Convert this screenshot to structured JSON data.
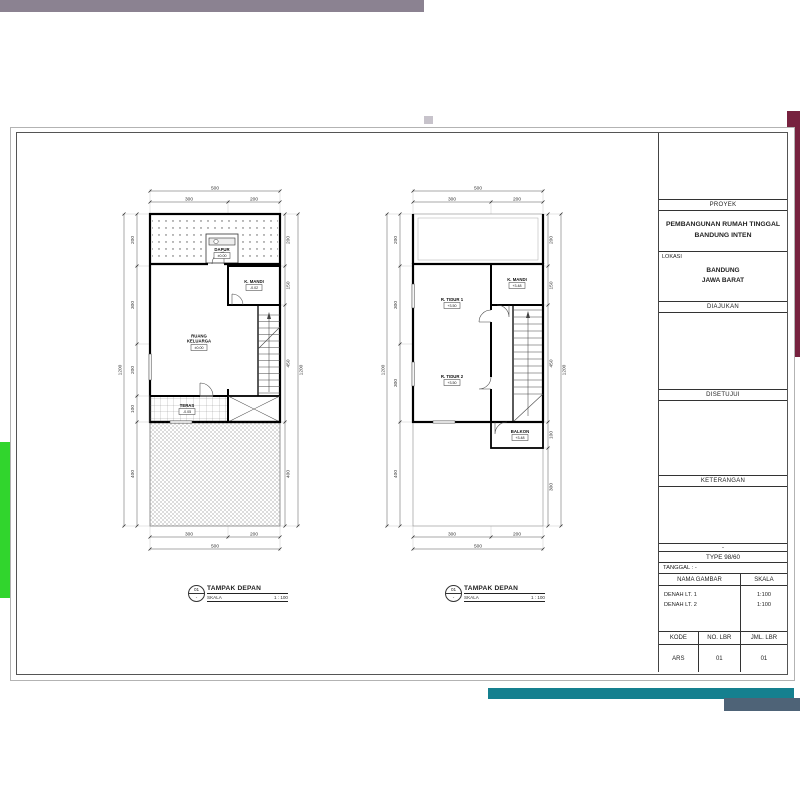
{
  "decor": {
    "gray": "#8b8291",
    "gray_stub": "#c7c3cb",
    "maroon": "#77223f",
    "green": "#31d52d",
    "teal": "#15808f",
    "slate": "#4e6377"
  },
  "title_block": {
    "proyek_label": "PROYEK",
    "proyek_line1": "PEMBANGUNAN RUMAH TINGGAL",
    "proyek_line2": "BANDUNG INTEN",
    "lokasi_label": "LOKASI",
    "lokasi_line1": "BANDUNG",
    "lokasi_line2": "JAWA BARAT",
    "diajukan_label": "DIAJUKAN",
    "disetujui_label": "DISETUJUI",
    "keterangan_label": "KETERANGAN",
    "dash": "-",
    "type_value": "TYPE 98/60",
    "tanggal_label": "TANGGAL : -",
    "nama_gambar_label": "NAMA GAMBAR",
    "skala_label": "SKALA",
    "drawings": [
      {
        "name": "DENAH LT. 1",
        "scale": "1:100"
      },
      {
        "name": "DENAH LT. 2",
        "scale": "1:100"
      }
    ],
    "kode_label": "KODE",
    "no_lbr_label": "NO. LBR",
    "jml_lbr_label": "JML. LBR",
    "kode_value": "ARS",
    "no_lbr_value": "01",
    "jml_lbr_value": "01"
  },
  "captions": [
    {
      "bubble_top": "01",
      "bubble_bottom": "-",
      "title": "TAMPAK DEPAN",
      "scale_label": "SKALA",
      "scale_value": "1 : 100"
    },
    {
      "bubble_top": "01",
      "bubble_bottom": "-",
      "title": "TAMPAK DEPAN",
      "scale_label": "SKALA",
      "scale_value": "1 : 100"
    }
  ],
  "plan1": {
    "dims": {
      "top_total": "500",
      "top_segments": [
        "300",
        "200"
      ],
      "left_total": "1200",
      "left_segments": [
        "200",
        "300",
        "200",
        "100",
        "400"
      ],
      "right_total": "1200",
      "right_segments": [
        "200",
        "150",
        "450",
        "400"
      ],
      "bottom_segments": [
        "300",
        "200"
      ],
      "bottom_total": "500"
    },
    "rooms": {
      "dapur": {
        "name": "DAPUR",
        "elev": "±0.00"
      },
      "kmandi": {
        "name": "K. MANDI",
        "elev": "-0.02"
      },
      "keluarga": {
        "line1": "RUANG",
        "line2": "KELUARGA",
        "elev": "±0.00"
      },
      "teras": {
        "name": "TERAS",
        "elev": "-0.05"
      }
    }
  },
  "plan2": {
    "dims": {
      "top_total": "500",
      "top_segments": [
        "300",
        "200"
      ],
      "left_total": "1200",
      "left_segments": [
        "200",
        "300",
        "300",
        "400"
      ],
      "right_total": "1200",
      "right_segments": [
        "200",
        "150",
        "450",
        "100",
        "300"
      ],
      "bottom_segments": [
        "300",
        "200"
      ],
      "bottom_total": "500"
    },
    "rooms": {
      "tidur1": {
        "name": "R. TIDUR 1",
        "elev": "+3.50"
      },
      "kmandi": {
        "name": "K. MANDI",
        "elev": "+3.48"
      },
      "tidur2": {
        "name": "R. TIDUR 2",
        "elev": "+3.50"
      },
      "balkon": {
        "name": "BALKON",
        "elev": "+3.48"
      }
    }
  }
}
